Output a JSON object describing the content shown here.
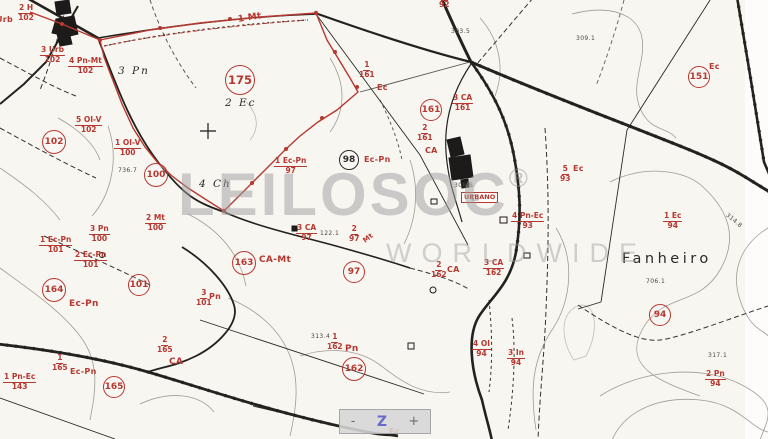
{
  "watermark": {
    "brand": "LEILOSOC",
    "reg": "®",
    "tagline": "WORLDWIDE"
  },
  "zoom_control": {
    "minus": "-",
    "zoom": "Z",
    "plus": "+"
  },
  "colors": {
    "annotation_red": "#b63831",
    "ink_black": "#2b2a27",
    "contour_gray": "#8a857c",
    "watermark_gray": "#9e9e9e",
    "paper": "#f8f6f1",
    "control_blue_z": "#6a6ac8"
  },
  "map": {
    "place_label": {
      "text": "Fanheiro",
      "x": 622,
      "y": 252
    },
    "urbano_label": {
      "text": "URBANO",
      "x": 461,
      "y": 192
    },
    "circles": [
      {
        "number": "175",
        "x": 239,
        "y": 79,
        "r": 14,
        "style": "big"
      },
      {
        "number": "102",
        "x": 53,
        "y": 141,
        "r": 11
      },
      {
        "number": "100",
        "x": 155,
        "y": 174,
        "r": 11
      },
      {
        "number": "164",
        "x": 53,
        "y": 289,
        "r": 11
      },
      {
        "number": "101",
        "x": 138,
        "y": 284,
        "r": 10
      },
      {
        "number": "165",
        "x": 113,
        "y": 386,
        "r": 10
      },
      {
        "number": "163",
        "x": 243,
        "y": 262,
        "r": 11
      },
      {
        "number": "97",
        "x": 353,
        "y": 271,
        "r": 10
      },
      {
        "number": "162",
        "x": 353,
        "y": 368,
        "r": 11
      },
      {
        "number": "161",
        "x": 430,
        "y": 109,
        "r": 10
      },
      {
        "number": "151",
        "x": 698,
        "y": 76,
        "r": 10
      },
      {
        "number": "94",
        "x": 659,
        "y": 314,
        "r": 10
      },
      {
        "number": "98",
        "x": 348,
        "y": 159,
        "r": 9,
        "style": "black"
      }
    ],
    "fractions": [
      {
        "num": "2 H",
        "den": "102",
        "x": 18,
        "y": 4
      },
      {
        "num": "3 Urb",
        "den": "102",
        "x": 40,
        "y": 46
      },
      {
        "num": "4 Pn-Mt",
        "den": "102",
        "x": 68,
        "y": 57
      },
      {
        "num": "5 OI-V",
        "den": "102",
        "x": 75,
        "y": 116
      },
      {
        "num": "1 OI-V",
        "den": "100",
        "x": 114,
        "y": 139
      },
      {
        "num": "2 Mt",
        "den": "100",
        "x": 145,
        "y": 214
      },
      {
        "num": "3 Pn",
        "den": "100",
        "x": 89,
        "y": 225
      },
      {
        "num": "1 Ec-Pn",
        "den": "101",
        "x": 39,
        "y": 236
      },
      {
        "num": "2 Ec-Pn",
        "den": "101",
        "x": 74,
        "y": 251
      },
      {
        "num": "1",
        "den": "165",
        "x": 52,
        "y": 354
      },
      {
        "num": "1 Pn-Ec",
        "den": "143",
        "x": 3,
        "y": 373
      },
      {
        "num": "2",
        "den": "165",
        "x": 157,
        "y": 336
      },
      {
        "num": "1 Ec-Pn",
        "den": "97",
        "x": 274,
        "y": 157
      },
      {
        "num": "3 CA",
        "den": "97",
        "x": 296,
        "y": 224
      },
      {
        "num": "2",
        "den": "97",
        "x": 349,
        "y": 225
      },
      {
        "num": "3",
        "den": "101",
        "x": 196,
        "y": 289
      },
      {
        "num": "1",
        "den": "162",
        "x": 327,
        "y": 333
      },
      {
        "num": "2",
        "den": "162",
        "x": 431,
        "y": 261
      },
      {
        "num": "3 CA",
        "den": "162",
        "x": 483,
        "y": 259
      },
      {
        "num": "4 OI",
        "den": "94",
        "x": 472,
        "y": 340
      },
      {
        "num": "3 In",
        "den": "94",
        "x": 507,
        "y": 349
      },
      {
        "num": "2 Pn",
        "den": "94",
        "x": 705,
        "y": 370
      },
      {
        "num": "1 Ec",
        "den": "94",
        "x": 663,
        "y": 212
      },
      {
        "num": "5",
        "den": "93",
        "x": 560,
        "y": 165
      },
      {
        "num": "4 Pn-Ec",
        "den": "93",
        "x": 511,
        "y": 212
      },
      {
        "num": "1",
        "den": "161",
        "x": 359,
        "y": 61
      },
      {
        "num": "3 CA",
        "den": "161",
        "x": 452,
        "y": 94
      },
      {
        "num": "2",
        "den": "161",
        "x": 417,
        "y": 124
      },
      {
        "num": "1",
        "den": "92",
        "x": 439,
        "y": -9
      }
    ],
    "labels": [
      {
        "t": "Urb",
        "x": -4,
        "y": 16,
        "c": "red"
      },
      {
        "t": "1 Mt",
        "x": 238,
        "y": 14,
        "c": "red",
        "rot": -9,
        "s": 9
      },
      {
        "t": "3 Pn",
        "x": 118,
        "y": 66,
        "c": "blackit"
      },
      {
        "t": "2 Ec",
        "x": 225,
        "y": 98,
        "c": "blackit"
      },
      {
        "t": "4 Ch",
        "x": 199,
        "y": 179,
        "c": "blackit"
      },
      {
        "t": "Ec",
        "x": 377,
        "y": 84,
        "c": "red"
      },
      {
        "t": "CA",
        "x": 425,
        "y": 147,
        "c": "red"
      },
      {
        "t": "Ec-Pn",
        "x": 364,
        "y": 156,
        "c": "red"
      },
      {
        "t": "CA-Mt",
        "x": 259,
        "y": 256,
        "c": "red",
        "s": 9
      },
      {
        "t": "Mt",
        "x": 363,
        "y": 235,
        "c": "red",
        "rot": -38,
        "s": 7
      },
      {
        "t": "Pn",
        "x": 209,
        "y": 293,
        "c": "red"
      },
      {
        "t": "Pn",
        "x": 345,
        "y": 345,
        "c": "red",
        "s": 9
      },
      {
        "t": "CA",
        "x": 447,
        "y": 266,
        "c": "red"
      },
      {
        "t": "Ec-Pn",
        "x": 69,
        "y": 300,
        "c": "red",
        "s": 9
      },
      {
        "t": "Ec-Pn",
        "x": 70,
        "y": 368,
        "c": "red"
      },
      {
        "t": "CA",
        "x": 169,
        "y": 358,
        "c": "red",
        "s": 9
      },
      {
        "t": "Ec",
        "x": 709,
        "y": 63,
        "c": "red"
      },
      {
        "t": "Ec",
        "x": 573,
        "y": 165,
        "c": "red"
      },
      {
        "t": "Ec",
        "x": 389,
        "y": 428,
        "c": "red"
      },
      {
        "t": "736.7",
        "x": 118,
        "y": 168,
        "c": "tiny"
      },
      {
        "t": "303.5",
        "x": 451,
        "y": 29,
        "c": "tiny"
      },
      {
        "t": "309.1",
        "x": 576,
        "y": 36,
        "c": "tiny"
      },
      {
        "t": "706.1",
        "x": 646,
        "y": 279,
        "c": "tiny"
      },
      {
        "t": "313.4",
        "x": 311,
        "y": 334,
        "c": "tiny"
      },
      {
        "t": "122.1",
        "x": 320,
        "y": 231,
        "c": "tiny"
      },
      {
        "t": "314.8",
        "x": 724,
        "y": 218,
        "c": "tiny",
        "rot": 40
      },
      {
        "t": "317.1",
        "x": 708,
        "y": 353,
        "c": "tiny"
      },
      {
        "t": "308 S",
        "x": 454,
        "y": 183,
        "c": "tiny"
      }
    ]
  }
}
